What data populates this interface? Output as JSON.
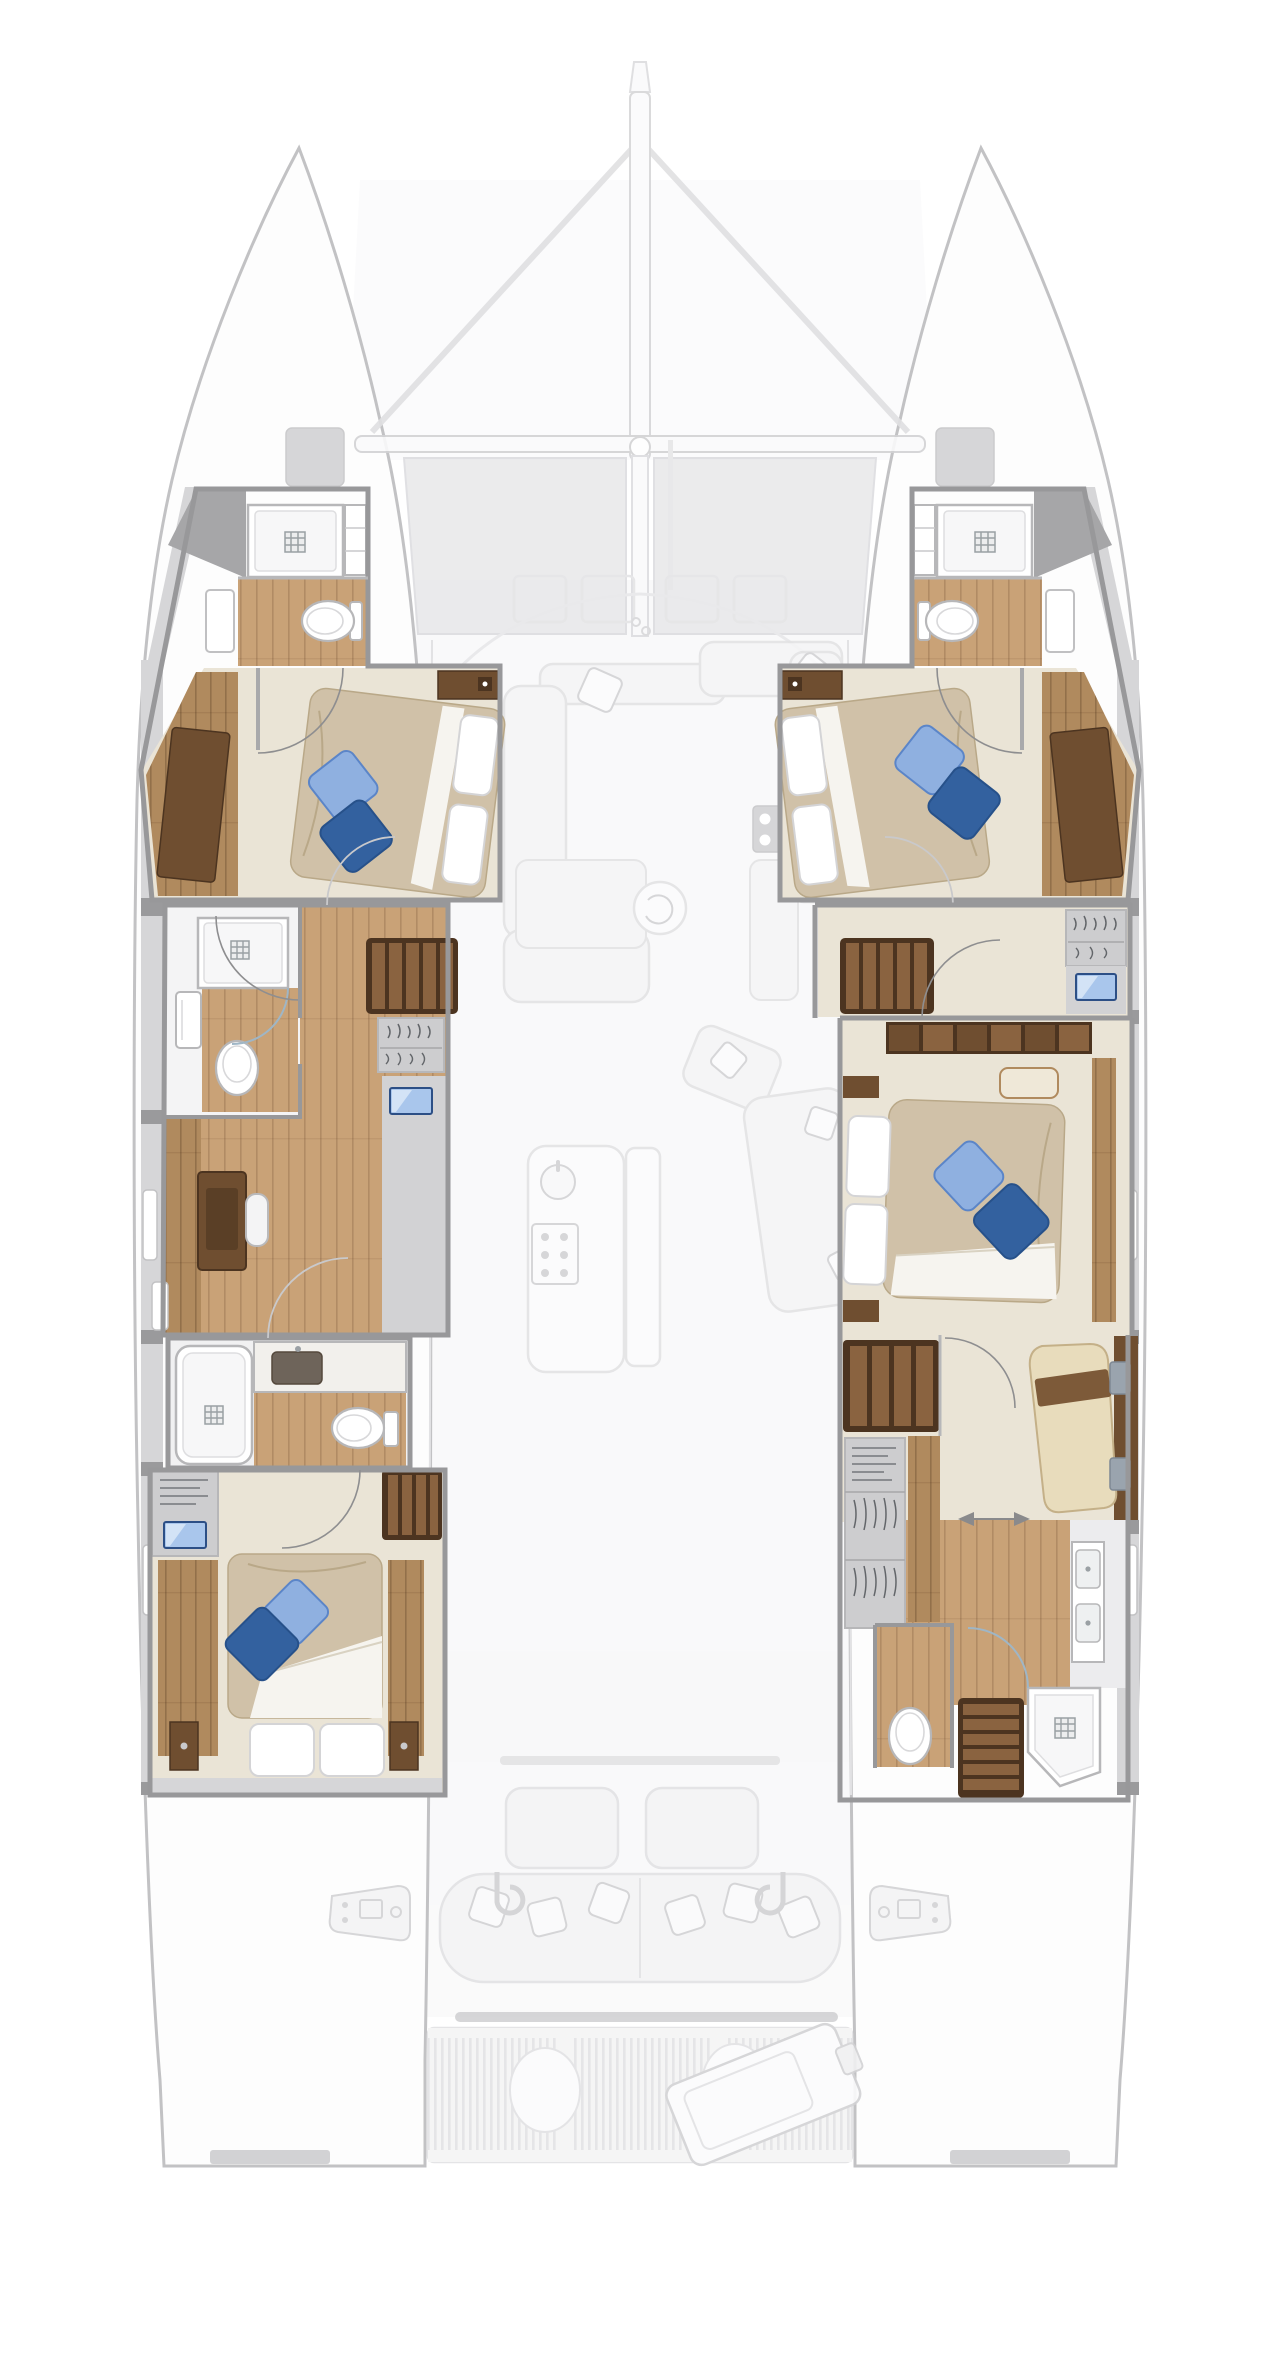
{
  "meta": {
    "description": "Catamaran yacht lower-deck interior floor plan, top-down view, with faded upper-deck overlay"
  },
  "colors": {
    "hull_line": "#c2c2c4",
    "hull_fill": "#fdfdfd",
    "ghost_fill": "#f4f4f5",
    "ghost_line": "#e2e2e4",
    "ghost_dark": "#d2d2d4",
    "wash": "#f8f8f9",
    "tramp": "#e9e9eb",
    "wall": "#98989a",
    "wall_light": "#b7b7b9",
    "band": "#d6d6d8",
    "band_dark": "#9a9a9c",
    "floor_beige": "#eae4d6",
    "floor_beige_dark": "#ddd5c2",
    "wood_light": "#c9a277",
    "wood_mid": "#b08a5e",
    "wood_dark": "#8a6340",
    "walnut": "#6f4e30",
    "walnut_deep": "#4c3420",
    "duvet": "#d0c1a8",
    "duvet_shade": "#b9a888",
    "sheet": "#f6f4ef",
    "pillow_white": "#ffffff",
    "pillow_blue_light": "#8fb0e0",
    "pillow_blue_mid": "#5b85c8",
    "pillow_blue_dark": "#33619f",
    "fixture_stroke": "#b7b7b9",
    "tray": "#f7f7f8",
    "drain": "#9aa0a4",
    "tv_screen": "#a9c6ec",
    "tv_screen_dark": "#4f7fc4",
    "tv_frame": "#2c4f86",
    "chaise": "#e8dcbc",
    "chaise_strap": "#7d5a39",
    "closet": "#cdcdcf",
    "clothes": "#63666a",
    "sink_dark": "#6e645a",
    "marble": "#f2f0ec",
    "glass": "#9fb6c6",
    "white_fixture": "#ffffff"
  },
  "legend": {
    "rooms": [
      {
        "id": "forward-port-cabin",
        "name": "Forward port guest cabin with angled double berth and en-suite shower room"
      },
      {
        "id": "forward-starboard-cabin",
        "name": "Forward starboard guest cabin with angled double berth and en-suite shower room"
      },
      {
        "id": "port-mid-bathroom",
        "name": "Port midship bathroom with shower, washbasin and toilet"
      },
      {
        "id": "port-desk-area",
        "name": "Port companionway with desk and sideboard"
      },
      {
        "id": "port-aft-bathroom",
        "name": "Port aft bathroom with bathtub, vanity sink and toilet"
      },
      {
        "id": "port-aft-cabin",
        "name": "Port aft cabin with double berth and TV panel"
      },
      {
        "id": "starboard-landing",
        "name": "Starboard companionway landing with stairs, locker and TV"
      },
      {
        "id": "master-cabin",
        "name": "Starboard master cabin with large double berth and wardrobe row"
      },
      {
        "id": "starboard-aft-suite",
        "name": "Starboard aft dressing room with chaise longue, hanging closet, twin-sink vanity, toilet and shower"
      },
      {
        "id": "salon",
        "name": "Faded main-deck salon with U-sofa, chaise, galley island and lounge chairs"
      },
      {
        "id": "cockpit",
        "name": "Faded aft cockpit with bench, tables and winch consoles"
      },
      {
        "id": "bow",
        "name": "Faded bow with trampoline, crossbeam and bowsprit"
      },
      {
        "id": "swim-platform",
        "name": "Faded swim platform with grating, engine hatches and dinghy"
      }
    ],
    "fixtures": [
      "shower",
      "shower-drain",
      "toilet",
      "washbasin",
      "bathtub",
      "double-berth",
      "white-pillow",
      "blue-pillow",
      "wardrobe",
      "hanging-locker",
      "stairs",
      "tv-screen",
      "chaise-longue",
      "desk",
      "galley-island",
      "cooktop",
      "sink",
      "salon-sofa",
      "cockpit-bench",
      "winch-console",
      "davit-hook",
      "swim-platform-grating",
      "engine-hatch",
      "dinghy",
      "trampoline",
      "crossbeam",
      "bowsprit",
      "door-swing-arc",
      "sliding-door-arrows",
      "hull-window"
    ]
  }
}
